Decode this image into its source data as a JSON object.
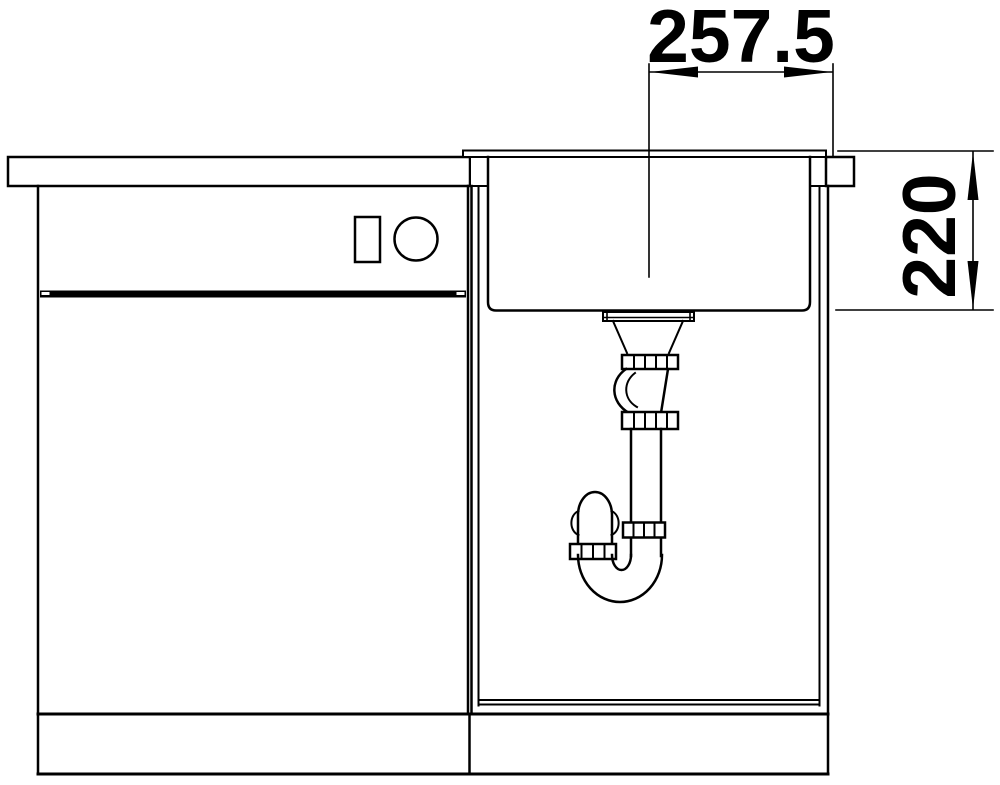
{
  "dims": {
    "horizontal": "257.5",
    "vertical": "220"
  },
  "colors": {
    "line": "#000000",
    "background": "#ffffff"
  }
}
